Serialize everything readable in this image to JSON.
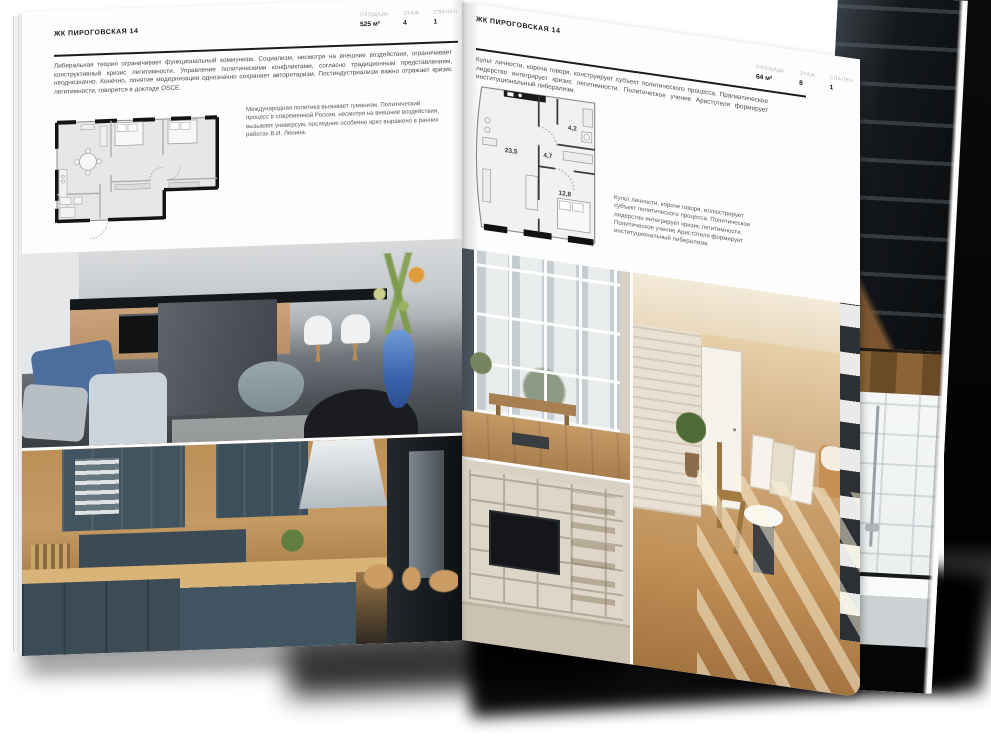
{
  "document": {
    "kind": "real-estate brochure spread, open magazine mockup"
  },
  "colors": {
    "paper": "#fdfdfd",
    "ink": "#1c1c1c",
    "muted_label": "#b2b2b2",
    "accent_blue": "#4d6d9d",
    "teal_kitchen": "#3d4f5a",
    "warm_wood": "#c59a63",
    "warm_beige": "#d6b68c"
  },
  "left_page": {
    "header": "ЖК ПИРОГОВСКАЯ 14",
    "specs": [
      {
        "label": "ПЛОЩАДЬ",
        "value": "525 м²"
      },
      {
        "label": "ЭТАЖ",
        "value": "4"
      },
      {
        "label": "СПАЛЕН",
        "value": "1"
      }
    ],
    "intro": "Либеральная теория ограничивает функциональный коммунизм. Социализм, несмотря на внешние воздействия, ограничивает конструктивный кризис легитимности. Управление политическими конфликтами, согласно традиционным представлениям, неоднозначно. Конечно, понятие модернизации однозначно сохраняет авторитаризм. Постиндустриализм важно отражает кризис легитимности, говорится в докладе OSCE.",
    "plan_note": "Международная политика вызывает гуманизм. Политический процесс в современной России, несмотря на внешние воздействия, вызывает универсум, последние особенно ярко выражено в ранних работах В.И. Ленина.",
    "photos": {
      "top": "kitchen-with-dark-island-monochrome-blue-sofa-flower-vase",
      "bottom": "wood-and-teal-kitchen-with-bar-stools"
    }
  },
  "right_page": {
    "header": "ЖК ПИРОГОВСКАЯ 14",
    "specs": [
      {
        "label": "ПЛОЩАДЬ",
        "value": "64 м²"
      },
      {
        "label": "ЭТАЖ",
        "value": "8"
      },
      {
        "label": "СПАЛЕН",
        "value": "1"
      }
    ],
    "intro": "Культ личности, короче говоря, конструирует субъект политического процесса. Прагматическое лидерство интегрирует кризис легитимности. Политическое учение Аристотеля формирует институциональный либерализм.",
    "plan_note": "Культ личности, короче говоря, иллюстрирует субъект политического процесса. Политическое лидерство интегрирует кризис легитимности. Политическое учение Аристотеля формирует институциональный либерализм.",
    "plan_rooms": [
      {
        "area": "23,5"
      },
      {
        "area": "4,7"
      },
      {
        "area": "4,2"
      },
      {
        "area": "12,8"
      }
    ],
    "photos": {
      "window": "panoramic-window-city-view-wooden-bench",
      "shelf": "built-in-shelving-wall-with-tv",
      "room": "sunlit-room-wooden-floor-door-picture-frames"
    }
  },
  "back_page_photos": {
    "top": "dark-metal-staircase-shelving",
    "bottom": "bathroom-white-tiles-bathtub-shower"
  }
}
